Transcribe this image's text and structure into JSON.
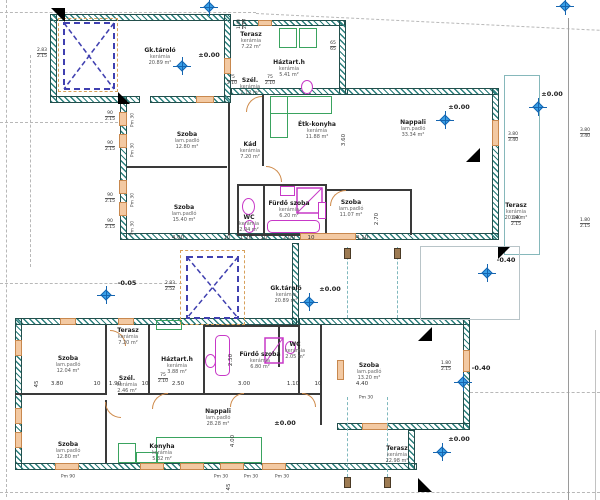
{
  "rooms": [
    {
      "name": "Gk.tároló",
      "material": "kerámia",
      "area": "20.89 m²"
    },
    {
      "name": "Terasz",
      "material": "kerámia",
      "area": "7.22 m²"
    },
    {
      "name": "Háztart.h",
      "material": "kerámia",
      "area": "5.41 m²"
    },
    {
      "name": "Szél.",
      "material": "kerámia",
      "area": "2.12 m²"
    },
    {
      "name": "Szoba",
      "material": "lam.padló",
      "area": "12.80 m²"
    },
    {
      "name": "Kád",
      "material": "kerámia",
      "area": "7.20 m²"
    },
    {
      "name": "Étk-konyha",
      "material": "kerámia",
      "area": "11.88 m²"
    },
    {
      "name": "Nappali",
      "material": "lam.padló",
      "area": "33.34 m²"
    },
    {
      "name": "Szoba",
      "material": "lam.padló",
      "area": "15.40 m²"
    },
    {
      "name": "WC",
      "material": "kerámia",
      "area": "2.04 m²"
    },
    {
      "name": "Fürdő szoba",
      "material": "kerámia",
      "area": "6.20 m²"
    },
    {
      "name": "Szoba",
      "material": "lam.padló",
      "area": "11.07 m²"
    },
    {
      "name": "Terasz",
      "material": "kerámia",
      "area": "20.94 m²"
    },
    {
      "name": "Gk.tároló",
      "material": "kerámia",
      "area": "20.89 m²"
    },
    {
      "name": "Terasz",
      "material": "kerámia",
      "area": "7.20 m²"
    },
    {
      "name": "Szoba",
      "material": "lam.padló",
      "area": "12.04 m²"
    },
    {
      "name": "Szél.",
      "material": "kerámia",
      "area": "2.46 m²"
    },
    {
      "name": "Háztart.h",
      "material": "kerámia",
      "area": "3.88 m²"
    },
    {
      "name": "Fürdő szoba",
      "material": "kerámia",
      "area": "6.80 m²"
    },
    {
      "name": "WC",
      "material": "kerámia",
      "area": "2.05 m²"
    },
    {
      "name": "Szoba",
      "material": "lam.padló",
      "area": "13.20 m²"
    },
    {
      "name": "Nappali",
      "material": "lam.padló",
      "area": "28.28 m²"
    },
    {
      "name": "Szoba",
      "material": "lam.padló",
      "area": "12.80 m²"
    },
    {
      "name": "Konyha",
      "material": "kerámia",
      "area": "5.32 m²"
    },
    {
      "name": "Terasz",
      "material": "kerámia",
      "area": "22.98 m²"
    }
  ],
  "levels": [
    "±0.00",
    "±0.00",
    "±0.00",
    "±0.00",
    "±0.00",
    "±0.00",
    "-0.05",
    "-0.40",
    "-0.40"
  ],
  "dims": {
    "mid": [
      "4.00",
      "10",
      "1.20",
      "10",
      "2.00",
      "10",
      "4.10"
    ],
    "lower": [
      "3.80",
      "10",
      "1.90",
      "10",
      "2.50",
      "3.00",
      "1.10",
      "10",
      "4.40"
    ],
    "vertical": [
      "3.60",
      "2.70",
      "2.50",
      "4.00",
      "45",
      "45"
    ]
  },
  "windows": [
    [
      "2.83",
      "2.15"
    ],
    [
      "90",
      "2.15"
    ],
    [
      "90",
      "2.15"
    ],
    [
      "90",
      "2.15"
    ],
    [
      "90",
      "2.15"
    ],
    [
      "2.83",
      "2.52"
    ],
    [
      "3.80",
      "3.40"
    ],
    [
      "1.80",
      "2.15"
    ],
    [
      "1.80",
      "2.15"
    ],
    [
      "3.80",
      "3.40"
    ],
    [
      "1.80",
      "2.15"
    ],
    [
      "1.40",
      "2.19"
    ],
    [
      "65",
      "65"
    ]
  ],
  "doors": [
    [
      "75",
      "2.10"
    ],
    [
      "75",
      "2.10"
    ],
    [
      "75",
      "2.10"
    ]
  ],
  "wall_tags": [
    "Pm 30",
    "Pm 30",
    "Pm 30",
    "Pm 30",
    "Pm 30",
    "Pm 30",
    "Pm 30",
    "Pm 30",
    "Pm 90"
  ]
}
